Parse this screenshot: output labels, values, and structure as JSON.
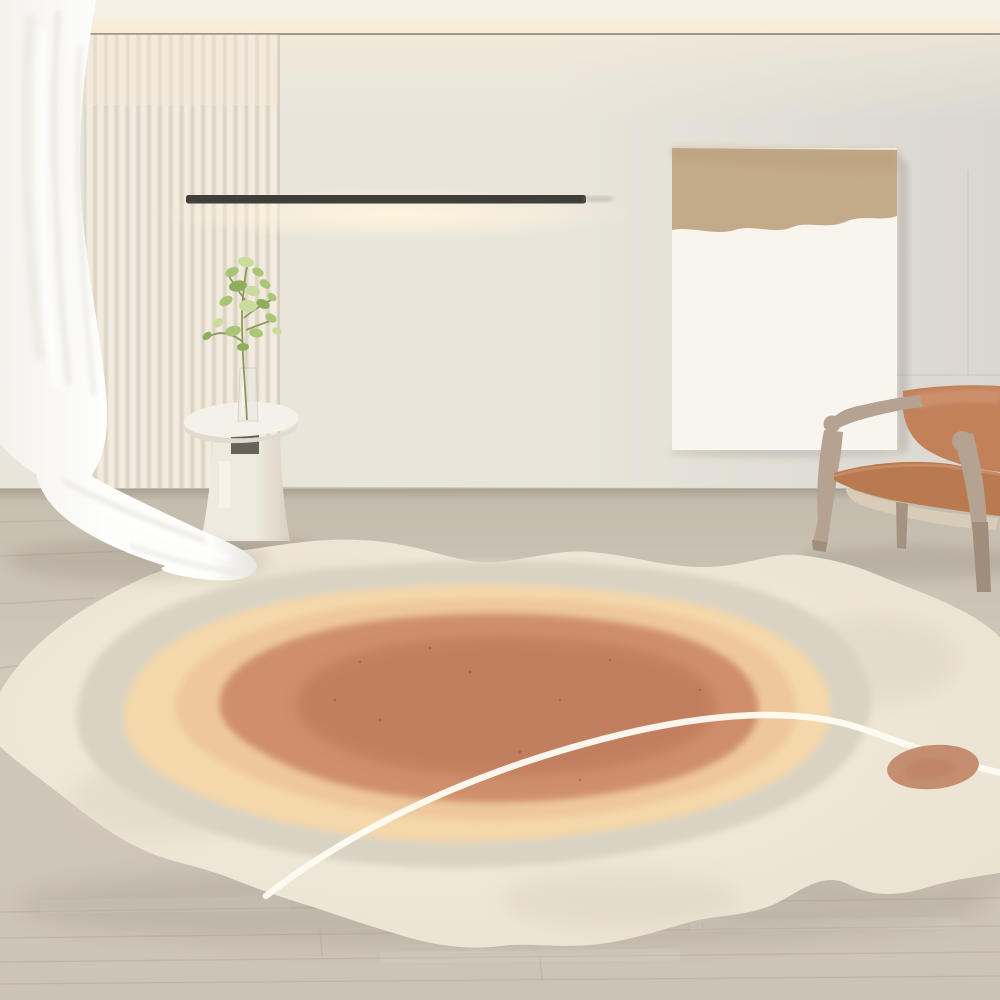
{
  "scene": {
    "type": "interior photograph",
    "room": "minimalist living room with organic abstract rug",
    "elements": {
      "ceiling": "ceiling with warm recessed cove lighting",
      "curtain": "sheer white curtain billowing at left",
      "slat_panel": "vertical wood slat wall panel",
      "light": "black linear wall-mounted light bar",
      "art": "two-tone abstract canvas leaning against wall",
      "table": "white pedestal side table",
      "plant": "green sprig in glass vase",
      "chair": "wooden armchair with cognac leather sling",
      "rug": "irregular organic rug with concentric cream, peach and terracotta fields, white orbit line and terracotta dot",
      "floor": "pale wood plank floor"
    }
  },
  "colors": {
    "ceiling": "#f4f0e6",
    "ceiling_glow": "#f8ecd2",
    "ceiling_rule": "#8d887b",
    "wall_left": "#e9e5db",
    "wall_right": "#dad7d0",
    "wall_warm": "#f4ecda",
    "seam": "#8a8376",
    "slat_light": "#f1ebe0",
    "slat_dark": "#ddd3c2",
    "slat_seam": "#c9c0b0",
    "light_bar": "#403e39",
    "light_glow": "#fff5dd",
    "bar_tail": "#8f8a7e",
    "canvas_white": "#f7f5ee",
    "canvas_tan": "#c3aa88",
    "canvas_tan_dark": "#b69c7a",
    "floor_top": "#c3bbac",
    "floor_mid": "#d0c8bb",
    "floor_bottom": "#cbc3b6",
    "floor_streak": "#dcd6cb",
    "plank_line": "#a79d8c",
    "baseboard": "#b3aa9b",
    "curtain_bright": "#fdfdfb",
    "curtain_mid": "#f4f2ed",
    "curtain_shade": "#e7e4de",
    "curtain_fold": "#e9e6e0",
    "white": "#ffffff",
    "table_top": "#f4f1e9",
    "table_edge": "#e0dbce",
    "table_ped_light": "#efeadf",
    "table_ped_dark": "#d7d0c1",
    "table_notch": "#56534b",
    "table_slot": "#f6f3ea",
    "vase_glass": "#e8e6df",
    "vase_line": "#c9c4b6",
    "stem_green": "#8a9a5b",
    "leaf_green": "#a9c575",
    "leaf_green_light": "#c9dc9c",
    "leaf_green_dark": "#8fae5c",
    "chair_wood": "#b5a290",
    "chair_wood_dark": "#a18d7b",
    "leather_back": "#c28159",
    "leather_light": "#d09674",
    "leather_seat": "#b97a4f",
    "chair_webbing": "#d9ccb9",
    "rug_cream": "#ebe3d2",
    "rug_cream_light": "#f3ecdc",
    "rug_patch": "#d7cfbd",
    "rug_gray": "#d9d3c3",
    "rug_peach_light": "#f4d7aa",
    "rug_peach_deep": "#eec89c",
    "rug_terra": "#cf8f6d",
    "rug_terra_dark": "#c07c5c",
    "rug_line": "#fdfbf3",
    "rug_dot": "#c68e70",
    "rug_dot_dark": "#b97f60",
    "speck": "#8a4f33",
    "shadow": "#6f675a"
  }
}
